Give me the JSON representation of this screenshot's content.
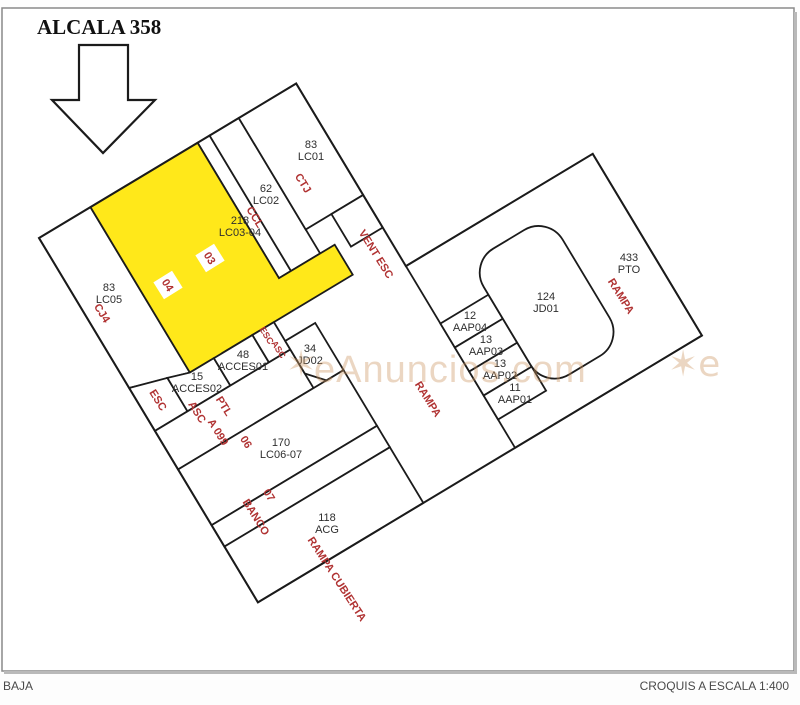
{
  "title": "ALCALA 358",
  "footer": {
    "left": "BAJA",
    "right": "CROQUIS A ESCALA 1:400"
  },
  "watermark": {
    "star": "✶",
    "text": "eAnuncios.com",
    "partial": "✶e"
  },
  "colors": {
    "highlight": "#ffe81a",
    "annotation": "#b03232",
    "line": "#1b1b1b"
  },
  "rooms": {
    "lc01": {
      "area": "83",
      "code": "LC01"
    },
    "lc02": {
      "area": "62",
      "code": "LC02"
    },
    "lc0304": {
      "area": "218",
      "code": "LC03-04"
    },
    "lc05": {
      "area": "83",
      "code": "LC05"
    },
    "jd02": {
      "area": "34",
      "code": "JD02"
    },
    "acces02": {
      "area": "15",
      "code": "ACCES02"
    },
    "acces01": {
      "area": "48",
      "code": "ACCES01"
    },
    "lc0607": {
      "area": "170",
      "code": "LC06-07"
    },
    "acg": {
      "area": "118",
      "code": "ACG"
    },
    "jd01": {
      "area": "124",
      "code": "JD01"
    },
    "pto": {
      "area": "433",
      "code": "PTO"
    },
    "aap04": {
      "area": "12",
      "code": "AAP04"
    },
    "aap03": {
      "area": "13",
      "code": "AAP03"
    },
    "aap02": {
      "area": "13",
      "code": "AAP02"
    },
    "aap01": {
      "area": "11",
      "code": "AAP01"
    }
  },
  "annotations": {
    "ctj": "CTJ",
    "ccl": "CCL",
    "vent_esc": "VENT ESC",
    "cj4": "CJ4",
    "esc_stair": "ESC",
    "esc_small": "ESC",
    "asc_small": "ASC",
    "asc_corridor": "ASC",
    "a099": "A 099",
    "ptl": "PTL",
    "n06": "06",
    "n07": "07",
    "banco": "BANCO",
    "rampa_center": "RAMPA",
    "rampa_right": "RAMPA",
    "rampa_cubierta": "RAMPA CUBIERTA",
    "u03": "03",
    "u04": "04"
  }
}
